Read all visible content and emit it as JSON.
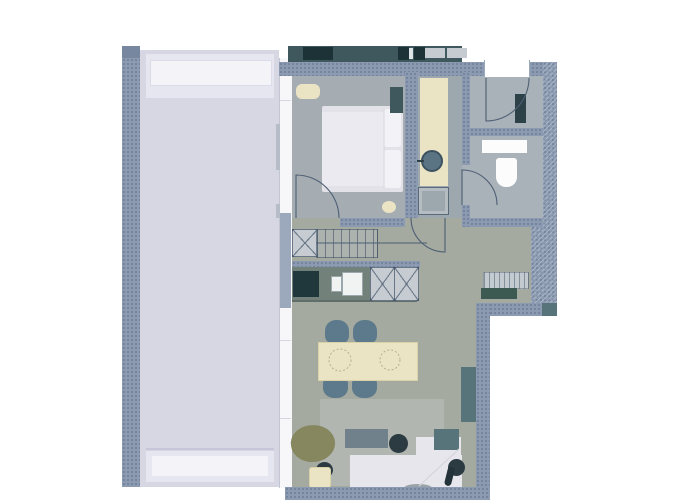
{
  "meta": {
    "type": "architectural-floor-plan",
    "description": "Top-down rendered apartment floor plan with terrace, no visible text labels"
  },
  "rooms": [
    {
      "name": "terrace"
    },
    {
      "name": "bedroom"
    },
    {
      "name": "bathroom-corridor"
    },
    {
      "name": "entry-wc"
    },
    {
      "name": "hall-closet"
    },
    {
      "name": "kitchen"
    },
    {
      "name": "dining-area"
    },
    {
      "name": "living-area"
    }
  ],
  "furniture": [
    "double-bed",
    "pillows",
    "blanket",
    "pouf",
    "wardrobe",
    "bedroom-stool",
    "vanity-counter",
    "round-washbasin",
    "shower",
    "wall-shelf",
    "toilet",
    "towel-radiator",
    "built-in-closet",
    "stairs",
    "kitchen-counter",
    "cooktop",
    "kitchen-sink",
    "tall-cabinets",
    "dining-table",
    "dining-chairs",
    "place-settings",
    "rug",
    "l-shaped-sofa",
    "coffee-table",
    "tv-table",
    "side-tables",
    "stool",
    "sideboard",
    "armchair",
    "lamp-table",
    "tray",
    "bottle",
    "bench",
    "planter-strips",
    "entrance-door",
    "interior-doors"
  ],
  "colors": {
    "wall": "#8c9bb2",
    "wall_dark": "#76879f",
    "terrace_floor": "#d7d7e4",
    "terrace_band": "#e6e6f0",
    "terrace_planter": "#f3f3f8",
    "terrace_line": "#c6c6d8",
    "facade": "#f7f7fa",
    "handle": "#b6bdc9",
    "divider": "#d5d7e2",
    "floor_living": "#a4aaa0",
    "floor_bedroom": "#a5adb3",
    "floor_corridor": "#9ca7ae",
    "floor_entry": "#a9b2b8",
    "counter": "#72817a",
    "cooktop": "#20383b",
    "sink": "#f1f3f3",
    "cabinet": "#c6ccd1",
    "teal_dark": "#3f585e",
    "teal": "#567479",
    "strip_dark": "#1d3236",
    "square": "#c5cbd1",
    "chair": "#5d7a8c",
    "cream": "#eae4c4",
    "white_furn": "#e7e6ed",
    "bed": "#e3e2e9",
    "bed_throw": "#ebeaf0",
    "pillow": "#f3f3f7",
    "rug": "#b1b6b1",
    "coffee_table": "#70818c",
    "dark_round": "#2c3a41",
    "armchair": "#86875f",
    "pure_white": "#fcfcfd",
    "dark_green": "#3c5a52",
    "radiator": "#2d4148",
    "basin": "#5b7484",
    "bench": "#c3cad0",
    "tray": "#9aa3a8",
    "bottle": "#24323a",
    "line": "#4e5f74"
  }
}
